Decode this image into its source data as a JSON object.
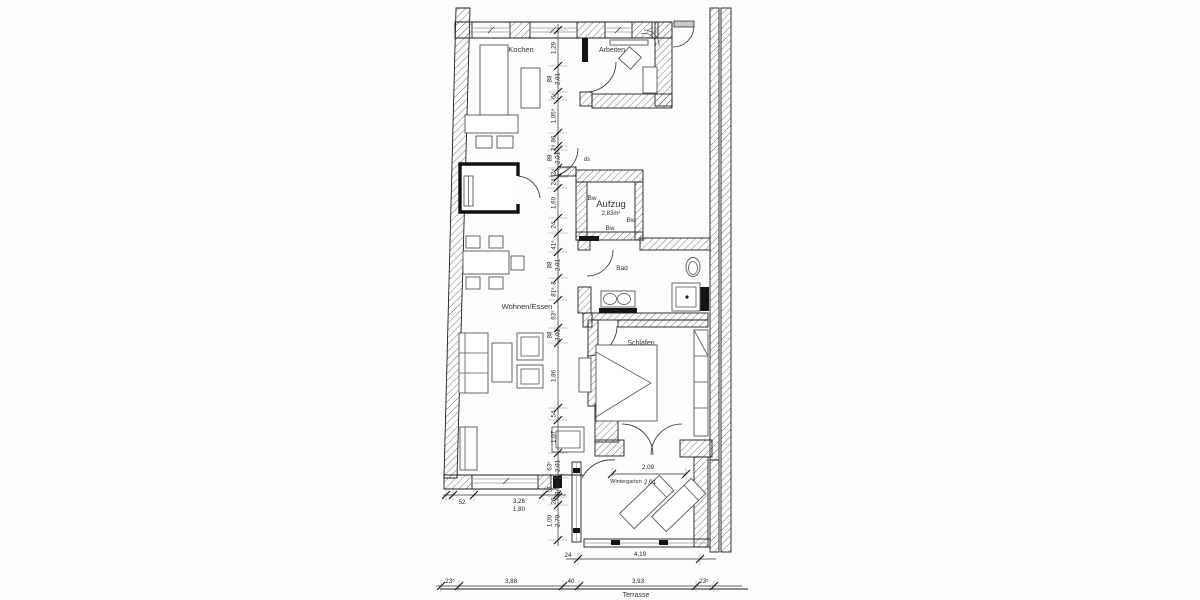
{
  "colors": {
    "paper": "#fdfdfc",
    "ink": "#1c1c1c",
    "hatch": "#6a6a6a",
    "furniture": "#555555",
    "glass": "#9b9b9b",
    "dark_fill": "#141414",
    "dim_text": "#222222"
  },
  "labels": {
    "kochen": "Kochen",
    "arbeiten": "Arbeiten",
    "bad": "Bad",
    "wohnen_essen": "Wohnen/Essen",
    "schlafen": "Schlafen",
    "wintergarten": "Wintergarten",
    "terrasse": "Terrasse",
    "ds": "ds",
    "aufzug_title": "Aufzug",
    "aufzug_area": "2,83m²",
    "bw_left": "Bw",
    "bw_right": "Bw",
    "bw_bottom": "Bw"
  },
  "dimensions": {
    "vchain": {
      "x": 558,
      "y1": 24,
      "y2": 546,
      "ticks": [
        30,
        66,
        92,
        100,
        133,
        146,
        150,
        168,
        177,
        188,
        218,
        233,
        252,
        278,
        300,
        328,
        343,
        408,
        420,
        453,
        478,
        497,
        505,
        540
      ],
      "labels": [
        {
          "y": 48,
          "t": "1,29"
        },
        {
          "y": 79,
          "t": "88",
          "t2": "2,01"
        },
        {
          "y": 96,
          "t": "6⁵"
        },
        {
          "y": 116,
          "t": "1,05⁵"
        },
        {
          "y": 139,
          "t": "86"
        },
        {
          "y": 148,
          "t": "2⁴"
        },
        {
          "y": 158,
          "t": "88",
          "t2": "2,01"
        },
        {
          "y": 172,
          "t": "2⁴"
        },
        {
          "y": 182,
          "t": "24"
        },
        {
          "y": 203,
          "t": "1,60"
        },
        {
          "y": 225,
          "t": "24"
        },
        {
          "y": 245,
          "t": "41⁵"
        },
        {
          "y": 265,
          "t": "88",
          "t2": "2,01"
        },
        {
          "y": 283,
          "t": "8"
        },
        {
          "y": 292,
          "t": "81⁵"
        },
        {
          "y": 315,
          "t": "63⁵"
        },
        {
          "y": 335,
          "t": "88",
          "t2": "2,01"
        },
        {
          "y": 376,
          "t": "1,86"
        },
        {
          "y": 414,
          "t": "54"
        },
        {
          "y": 437,
          "t": "1,07"
        },
        {
          "y": 466,
          "t": "63⁵",
          "t2": "2,01"
        },
        {
          "y": 489,
          "t": "51",
          "t2": "2,70"
        },
        {
          "y": 501,
          "t": "26"
        },
        {
          "y": 521,
          "t": "1,00",
          "t2": "2,70"
        }
      ]
    },
    "hchains": [
      {
        "y": 495,
        "x1": 443,
        "x2": 566,
        "ticks": [
          446,
          453,
          474,
          543,
          557
        ],
        "labels": [
          {
            "x": 462,
            "y": 504,
            "t": "52"
          },
          {
            "x": 519,
            "y": 503,
            "t": "3,26"
          },
          {
            "x": 519,
            "y": 511,
            "t": "1,80"
          }
        ]
      },
      {
        "y": 559,
        "x1": 566,
        "x2": 716,
        "ticks": [
          578,
          700
        ],
        "labels": [
          {
            "x": 640,
            "y": 556,
            "t": "4,19"
          },
          {
            "x": 568,
            "y": 557,
            "t": "24"
          }
        ]
      },
      {
        "y": 586,
        "x1": 436,
        "x2": 742,
        "ticks": [
          441,
          459,
          563,
          579,
          696,
          714
        ],
        "labels": [
          {
            "x": 450,
            "y": 583,
            "t": "23⁵"
          },
          {
            "x": 511,
            "y": 583,
            "t": "3,88"
          },
          {
            "x": 571,
            "y": 583,
            "t": "40"
          },
          {
            "x": 638,
            "y": 583,
            "t": "3,93"
          },
          {
            "x": 704,
            "y": 583,
            "t": "23⁵"
          }
        ]
      },
      {
        "y": 474,
        "x1": 612,
        "x2": 686,
        "ticks": [
          612,
          686
        ],
        "labels": [
          {
            "x": 648,
            "y": 469,
            "t": "2,09",
            "fs": 9.5
          },
          {
            "x": 650,
            "y": 484,
            "t": "2,01",
            "fs": 9.5
          }
        ]
      }
    ]
  }
}
